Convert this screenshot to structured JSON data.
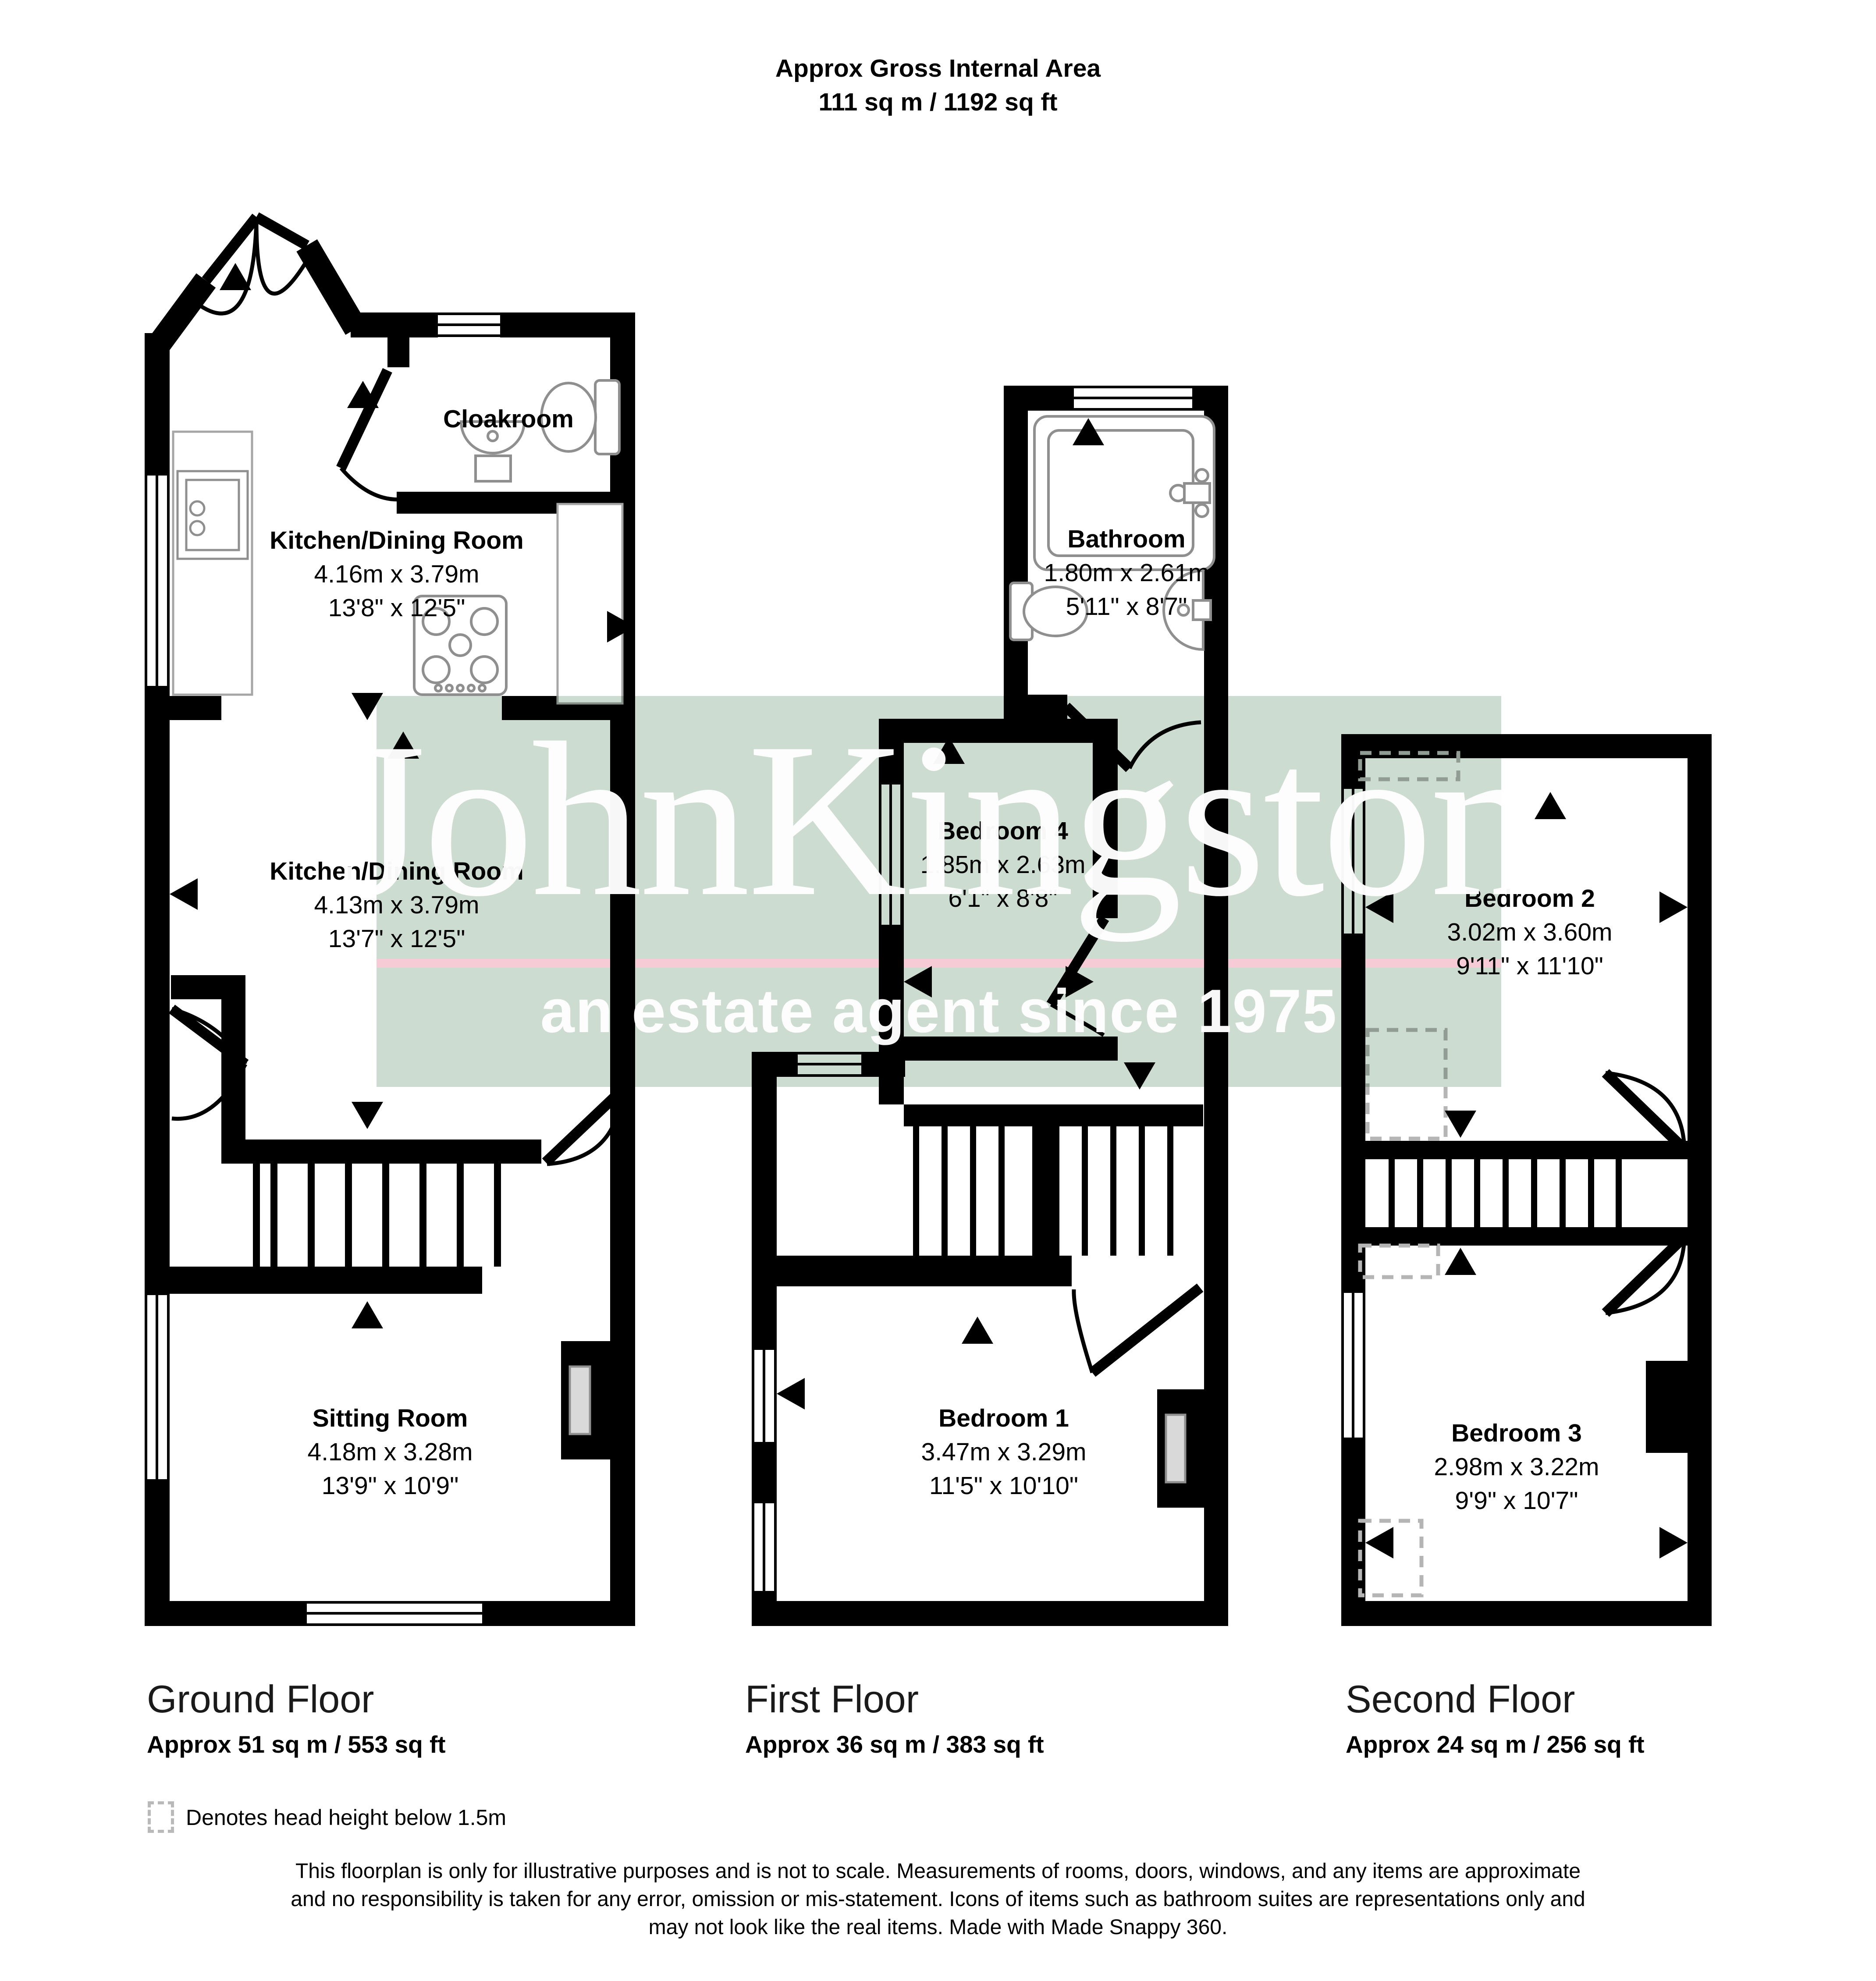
{
  "title": {
    "line1": "Approx Gross Internal Area",
    "line2": "111 sq m / 1192 sq ft"
  },
  "watermark": {
    "name": "JohnKingston",
    "tagline": "an estate agent since 1975",
    "band_color": "#cddcd0",
    "stripe_color": "#f7cbd6"
  },
  "floors": [
    {
      "id": "ground",
      "label": "Ground Floor",
      "area": "Approx 51 sq m / 553 sq ft",
      "rooms": [
        {
          "id": "cloakroom",
          "name": "Cloakroom",
          "dims_m": "",
          "dims_ft": ""
        },
        {
          "id": "kitchen-dining-upper",
          "name": "Kitchen/Dining Room",
          "dims_m": "4.16m x 3.79m",
          "dims_ft": "13'8\" x 12'5\""
        },
        {
          "id": "kitchen-dining-lower",
          "name": "Kitchen/Dining Room",
          "dims_m": "4.13m x 3.79m",
          "dims_ft": "13'7\" x 12'5\""
        },
        {
          "id": "sitting-room",
          "name": "Sitting Room",
          "dims_m": "4.18m x 3.28m",
          "dims_ft": "13'9\" x 10'9\""
        }
      ]
    },
    {
      "id": "first",
      "label": "First Floor",
      "area": "Approx 36 sq m / 383 sq ft",
      "rooms": [
        {
          "id": "bathroom",
          "name": "Bathroom",
          "dims_m": "1.80m x 2.61m",
          "dims_ft": "5'11\" x 8'7\""
        },
        {
          "id": "bedroom-4",
          "name": "Bedroom 4",
          "dims_m": "1.85m x 2.63m",
          "dims_ft": "6'1\" x 8'8\""
        },
        {
          "id": "bedroom-1",
          "name": "Bedroom 1",
          "dims_m": "3.47m x 3.29m",
          "dims_ft": "11'5\" x 10'10\""
        }
      ]
    },
    {
      "id": "second",
      "label": "Second Floor",
      "area": "Approx 24 sq m / 256 sq ft",
      "rooms": [
        {
          "id": "bedroom-2",
          "name": "Bedroom 2",
          "dims_m": "3.02m x 3.60m",
          "dims_ft": "9'11\" x 11'10\""
        },
        {
          "id": "bedroom-3",
          "name": "Bedroom 3",
          "dims_m": "2.98m x 3.22m",
          "dims_ft": "9'9\" x 10'7\""
        }
      ]
    }
  ],
  "legend": {
    "text": "Denotes head height below 1.5m"
  },
  "disclaimer": {
    "line1": "This floorplan is only for illustrative purposes and is not to scale. Measurements of rooms, doors, windows, and any items are approximate",
    "line2": "and no responsibility is taken for any error, omission or mis-statement. Icons of items such as bathroom suites are representations only and",
    "line3": "may not look like the real items. Made with Made Snappy 360."
  }
}
